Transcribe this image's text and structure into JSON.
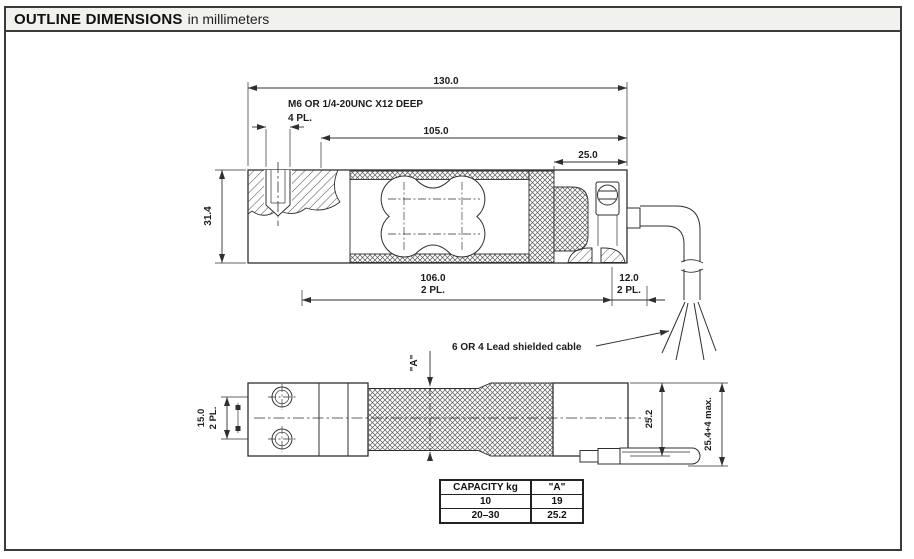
{
  "header": {
    "title_bold": "OUTLINE DIMENSIONS",
    "title_suffix": "in millimeters"
  },
  "top_view": {
    "dim_130": "130.0",
    "note_thread_line1": "M6 OR 1/4-20UNC X12 DEEP",
    "note_thread_line2": "4 PL.",
    "dim_105": "105.0",
    "dim_25": "25.0",
    "dim_31_4": "31.4",
    "dim_106": "106.0",
    "dim_106_pl": "2 PL.",
    "dim_12": "12.0",
    "dim_12_pl": "2 PL.",
    "cable_note": "6 OR 4 Lead shielded cable"
  },
  "side_view": {
    "dim_a_label": "\"A\"",
    "dim_15": "15.0",
    "dim_15_pl": "2 PL.",
    "dim_25_2": "25.2",
    "dim_25_4": "25.4+4 max."
  },
  "capacity_table": {
    "headers": [
      "CAPACITY kg",
      "\"A\""
    ],
    "rows": [
      [
        "10",
        "19"
      ],
      [
        "20–30",
        "25.2"
      ]
    ]
  },
  "colors": {
    "line": "#2f2f2f",
    "title_bg": "#f1f1ee",
    "frame_border": "#3a3a3a"
  }
}
